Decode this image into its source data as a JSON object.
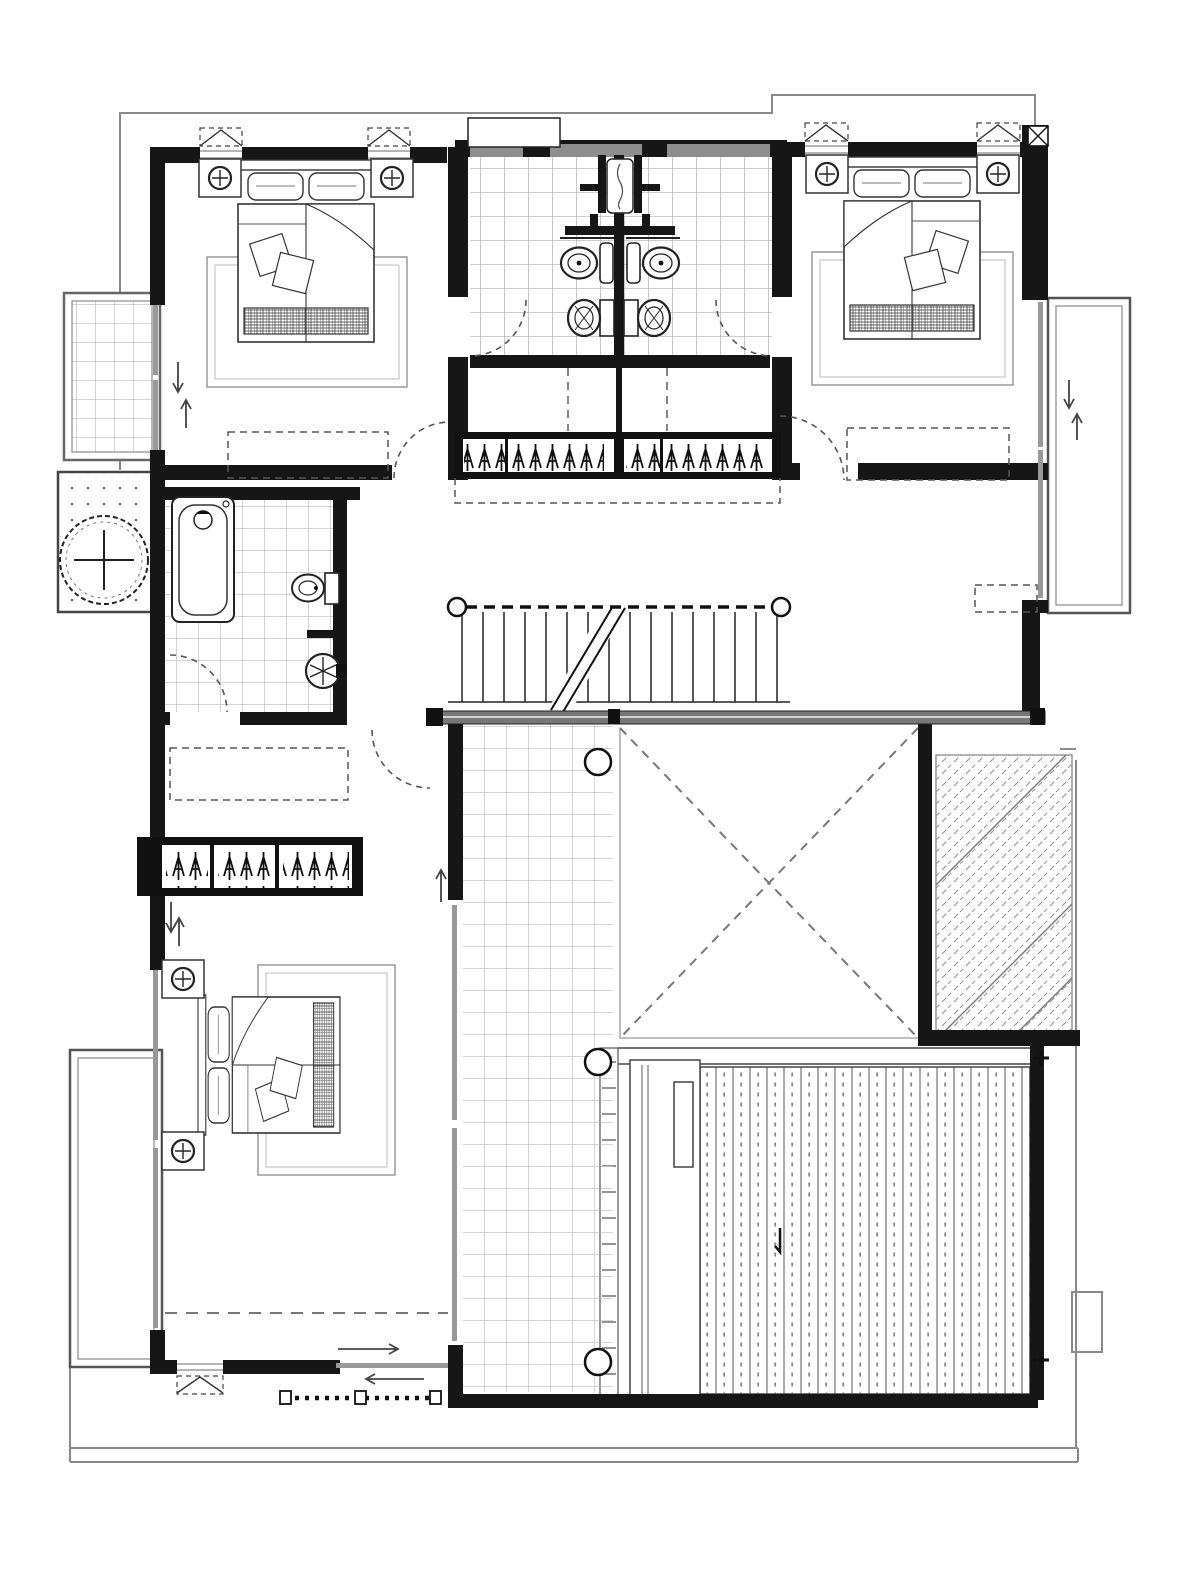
{
  "document": {
    "type": "architectural-floor-plan",
    "floor": "upper-floor",
    "style": "black-and-white CAD line drawing, no text labels",
    "canvas": {
      "width": 1200,
      "height": 1576
    }
  },
  "colors": {
    "background": "#ffffff",
    "wall": "#161616",
    "wall_band": "#8e8e8e",
    "tile_line": "#aaaaaa",
    "bath_tile_line": "#9a9a9a",
    "detail": "#333333",
    "annotation_dash": "#555555",
    "light_dash": "#777777",
    "eave_line": "#8a8a8a",
    "railing_fill": "#777777",
    "glass": "#999999",
    "deck_line": "#666666",
    "hatch_line": "#999999"
  },
  "plan": {
    "rooms": [
      {
        "name": "bedroom-top-left",
        "features": [
          "double-bed",
          "two-nightstands-with-lamps",
          "rug",
          "casement-windows-top",
          "tiled-balcony-left",
          "sliding-door-arrows",
          "dashed-bulkhead",
          "door-to-closet"
        ]
      },
      {
        "name": "shared-bathroom-top-center",
        "features": [
          "two-sinks-back-to-back",
          "two-toilets",
          "central-shower",
          "tiled-floor",
          "doors-from-both-bedrooms",
          "roof-feature-above"
        ]
      },
      {
        "name": "bedroom-top-right",
        "features": [
          "double-bed",
          "two-nightstands-with-lamps",
          "rug",
          "casement-windows-top",
          "balcony-right",
          "column-with-x-hatch",
          "dashed-bulkhead"
        ]
      },
      {
        "name": "walk-through-closet",
        "features": [
          "wardrobe-with-hangers",
          "center-divider",
          "dashed-door-swings-both-ends",
          "dashed-projection"
        ]
      },
      {
        "name": "stair-hall",
        "features": [
          "staircase",
          "dashed-handrail",
          "newel-posts",
          "break-line",
          "gallery-railing"
        ]
      },
      {
        "name": "bathroom-left",
        "features": [
          "bathtub",
          "toilet",
          "round-washbasin",
          "tiled-floor",
          "door-swing"
        ]
      },
      {
        "name": "courtyard-planter-left",
        "features": [
          "tree-symbol",
          "dotted-paving"
        ]
      },
      {
        "name": "master-bedroom-bottom-left",
        "features": [
          "double-bed",
          "two-nightstands-with-lamps",
          "rug",
          "wardrobe-with-hangers",
          "balcony-left",
          "window-walls",
          "sliding-door-bottom",
          "dotted-fence-below",
          "dashed-ceiling-line",
          "casement-window-bottom"
        ]
      },
      {
        "name": "gallery-corridor",
        "features": [
          "tiled-floor",
          "three-round-columns",
          "louver-grate-edge"
        ]
      },
      {
        "name": "double-height-void",
        "features": [
          "dashed-x-cross"
        ]
      },
      {
        "name": "sloped-roof-right",
        "features": [
          "diagonal-hatch"
        ]
      },
      {
        "name": "wood-deck-bottom-right",
        "features": [
          "vertical-plank-dotted-pattern",
          "plus-survey-marks",
          "planter-strip",
          "bench-box"
        ]
      }
    ],
    "fixture_counts": {
      "beds": 3,
      "nightstand_lamps": 6,
      "sinks": 3,
      "toilets": 3,
      "bathtubs": 1,
      "showers": 1,
      "wardrobes": 3,
      "columns": 3,
      "balconies": 3,
      "trees": 1,
      "stairs": 1
    }
  }
}
